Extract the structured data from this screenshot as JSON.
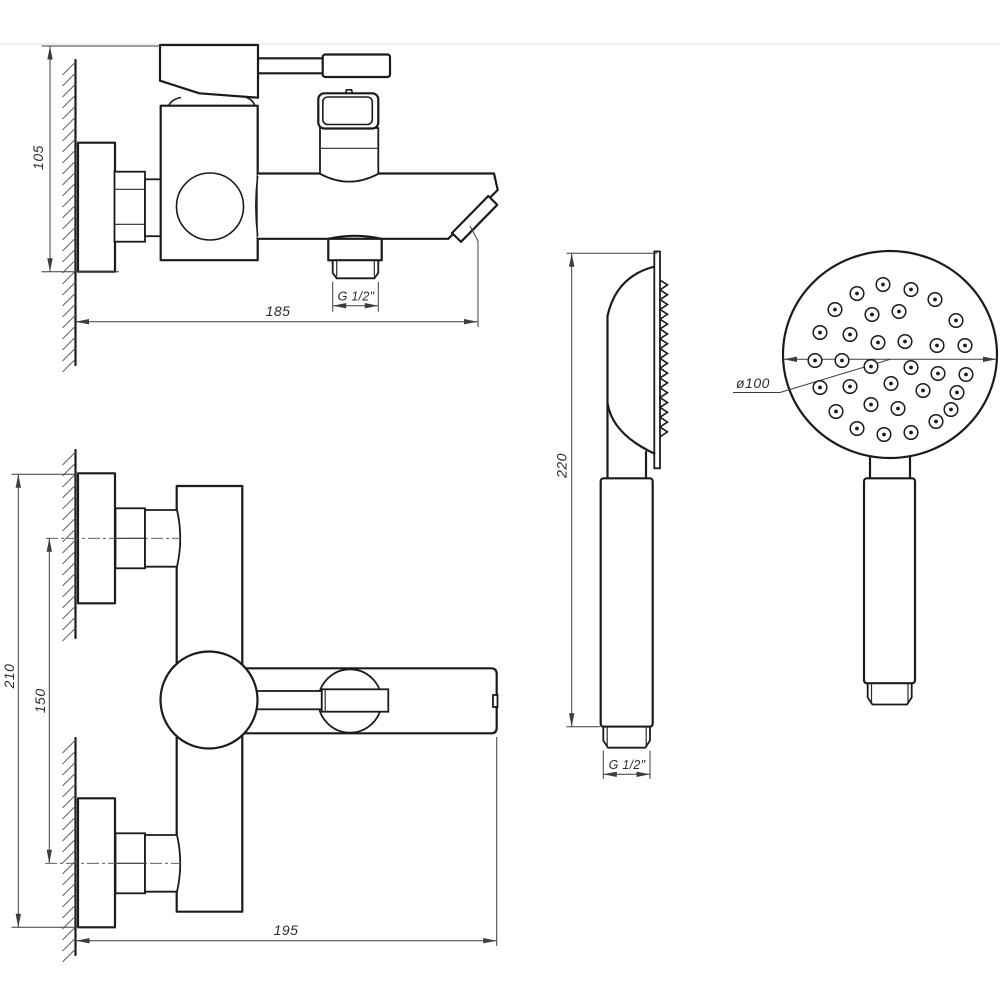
{
  "labels": {
    "faucet_side": {
      "height": "105",
      "length": "185",
      "thread": "G 1/2\""
    },
    "faucet_front": {
      "height": "210",
      "centers": "150",
      "length": "195"
    },
    "shower_side": {
      "length": "220",
      "thread": "G 1/2\""
    },
    "shower_front": {
      "diameter": "ø100"
    }
  },
  "colors": {
    "line": "#1b1b1b",
    "dim": "#3d3d3d",
    "background": "#ffffff"
  },
  "drawing": {
    "hatch": {
      "spacing": 11,
      "len": 13,
      "segments": [
        {
          "x": 75.5,
          "y1": 62,
          "y2": 360
        },
        {
          "x": 75.5,
          "y1": 452,
          "y2": 634
        },
        {
          "x": 75.5,
          "y1": 740,
          "y2": 950
        }
      ]
    },
    "teeth": {
      "x": 660,
      "top": 280,
      "pitch": 9.8,
      "count": 16,
      "depth": 7.5
    },
    "nozzles": {
      "cx": 890,
      "cy": 354.5,
      "r_outer": 6.8,
      "r_inner": 1.9,
      "offsets": [
        [
          -7,
          -70
        ],
        [
          21,
          -65
        ],
        [
          -33,
          -61
        ],
        [
          45,
          -55
        ],
        [
          -55,
          -45
        ],
        [
          -18,
          -40
        ],
        [
          9,
          -43
        ],
        [
          66,
          -34
        ],
        [
          -70,
          -22
        ],
        [
          -40,
          -20
        ],
        [
          -12,
          -12
        ],
        [
          15,
          -13
        ],
        [
          47,
          -9
        ],
        [
          75,
          -9
        ],
        [
          -75,
          6
        ],
        [
          -48,
          6
        ],
        [
          -19,
          12
        ],
        [
          21,
          13
        ],
        [
          48,
          19
        ],
        [
          76,
          20
        ],
        [
          -70,
          33
        ],
        [
          -40,
          32
        ],
        [
          1,
          29
        ],
        [
          33,
          36
        ],
        [
          67,
          38
        ],
        [
          -54,
          57
        ],
        [
          -19,
          50
        ],
        [
          8,
          54
        ],
        [
          46,
          67
        ],
        [
          61,
          55
        ],
        [
          -33,
          74
        ],
        [
          -6,
          80
        ],
        [
          21,
          78
        ]
      ]
    },
    "arrows": [
      [
        50,
        46,
        "up"
      ],
      [
        50,
        271.7,
        "down"
      ],
      [
        75.5,
        321.7,
        "left"
      ],
      [
        477.5,
        321.7,
        "right"
      ],
      [
        332.7,
        305.7,
        "left"
      ],
      [
        378.3,
        305.7,
        "right"
      ],
      [
        18.3,
        474.3,
        "up"
      ],
      [
        18.3,
        927.3,
        "down"
      ],
      [
        49.3,
        538.3,
        "up"
      ],
      [
        49.3,
        863.3,
        "down"
      ],
      [
        76,
        940.7,
        "left"
      ],
      [
        496.7,
        940.7,
        "right"
      ],
      [
        571.7,
        253.3,
        "up"
      ],
      [
        571.7,
        726.7,
        "down"
      ],
      [
        603.3,
        774.3,
        "left"
      ],
      [
        650,
        774.3,
        "right"
      ],
      [
        783.5,
        359.3,
        "left"
      ],
      [
        996.5,
        359.3,
        "right"
      ]
    ]
  }
}
